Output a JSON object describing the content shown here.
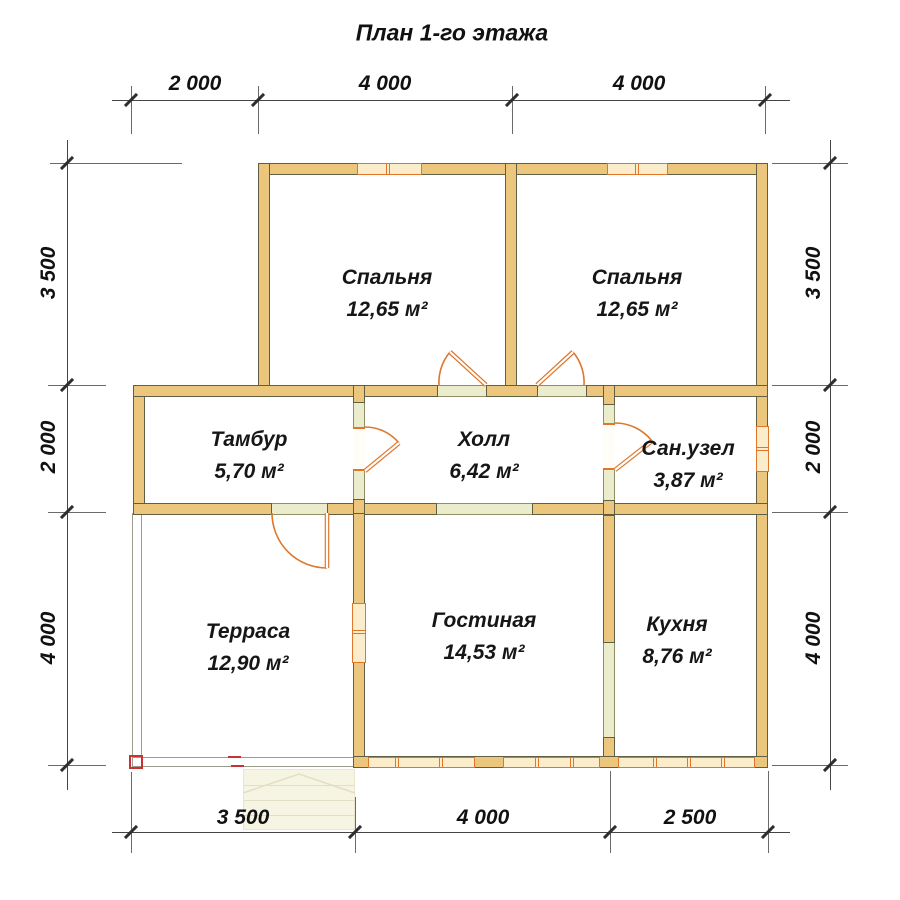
{
  "title": "План 1-го этажа",
  "rooms": {
    "bedroom_left": {
      "name": "Спальня",
      "area": "12,65 м²"
    },
    "bedroom_right": {
      "name": "Спальня",
      "area": "12,65 м²"
    },
    "tambour": {
      "name": "Тамбур",
      "area": "5,70 м²"
    },
    "hall": {
      "name": "Холл",
      "area": "6,42 м²"
    },
    "bathroom": {
      "name": "Сан.узел",
      "area": "3,87 м²"
    },
    "terrace": {
      "name": "Терраса",
      "area": "12,90 м²"
    },
    "living_room": {
      "name": "Гостиная",
      "area": "14,53 м²"
    },
    "kitchen": {
      "name": "Кухня",
      "area": "8,76 м²"
    }
  },
  "dimensions": {
    "top": [
      "2 000",
      "4 000",
      "4 000"
    ],
    "left": [
      "3 500",
      "2 000",
      "4 000"
    ],
    "right": [
      "3 500",
      "2 000",
      "4 000"
    ],
    "bottom": [
      "3 500",
      "4 000",
      "2 500"
    ]
  },
  "colors": {
    "wall_fill": "#ecc67d",
    "wall_outline": "#5f5f44",
    "window_fill": "#fbeccc",
    "accent_orange": "#e0762a",
    "opening_fill": "#ebeccb",
    "dimension_line": "#454545",
    "text": "#111111",
    "marker_red": "#c83232",
    "stairs_fill": "#f6f4e3"
  }
}
